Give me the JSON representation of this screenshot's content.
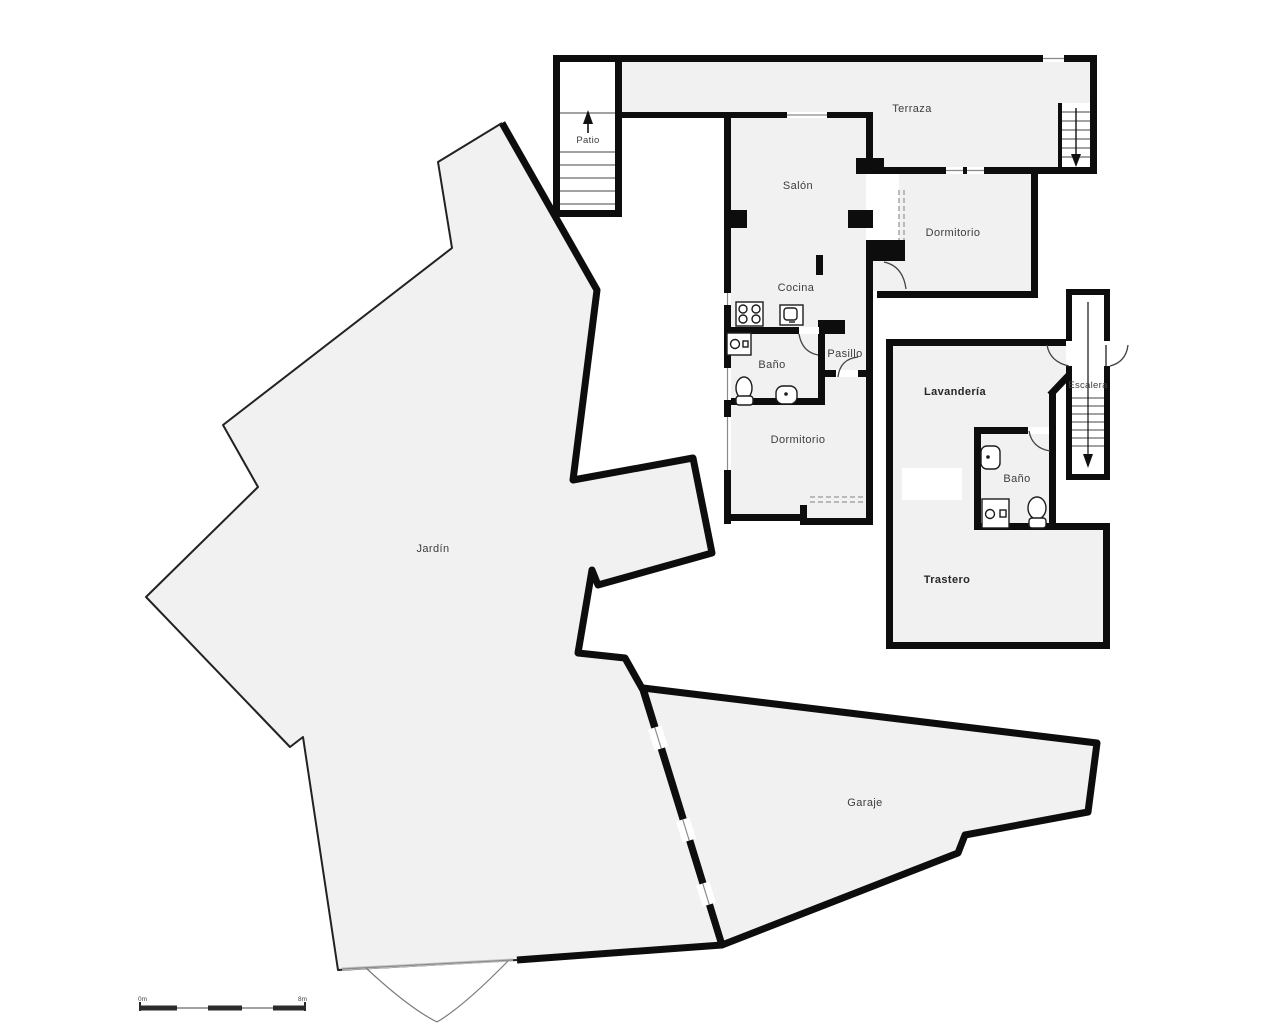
{
  "title": "Floor plan",
  "colors": {
    "wall": "#0d0d0d",
    "room_fill": "#f1f1f1",
    "outline_thin": "#222222",
    "detail_line": "#555555",
    "dash_line": "#999999",
    "background": "#ffffff"
  },
  "rooms": [
    {
      "id": "patio",
      "label": "Patio"
    },
    {
      "id": "terraza",
      "label": "Terraza"
    },
    {
      "id": "salon",
      "label": "Salón"
    },
    {
      "id": "dormitorio-1",
      "label": "Dormitorio"
    },
    {
      "id": "cocina",
      "label": "Cocina"
    },
    {
      "id": "bano-1",
      "label": "Baño"
    },
    {
      "id": "pasillo",
      "label": "Pasillo"
    },
    {
      "id": "dormitorio-2",
      "label": "Dormitorio"
    },
    {
      "id": "lavanderia",
      "label": "Lavandería"
    },
    {
      "id": "escalera",
      "label": "Escalera"
    },
    {
      "id": "bano-2",
      "label": "Baño"
    },
    {
      "id": "trastero",
      "label": "Trastero"
    },
    {
      "id": "jardin",
      "label": "Jardín"
    },
    {
      "id": "garaje",
      "label": "Garaje"
    }
  ],
  "scale_bar": {
    "start_label": "0m",
    "end_label": "8m"
  }
}
